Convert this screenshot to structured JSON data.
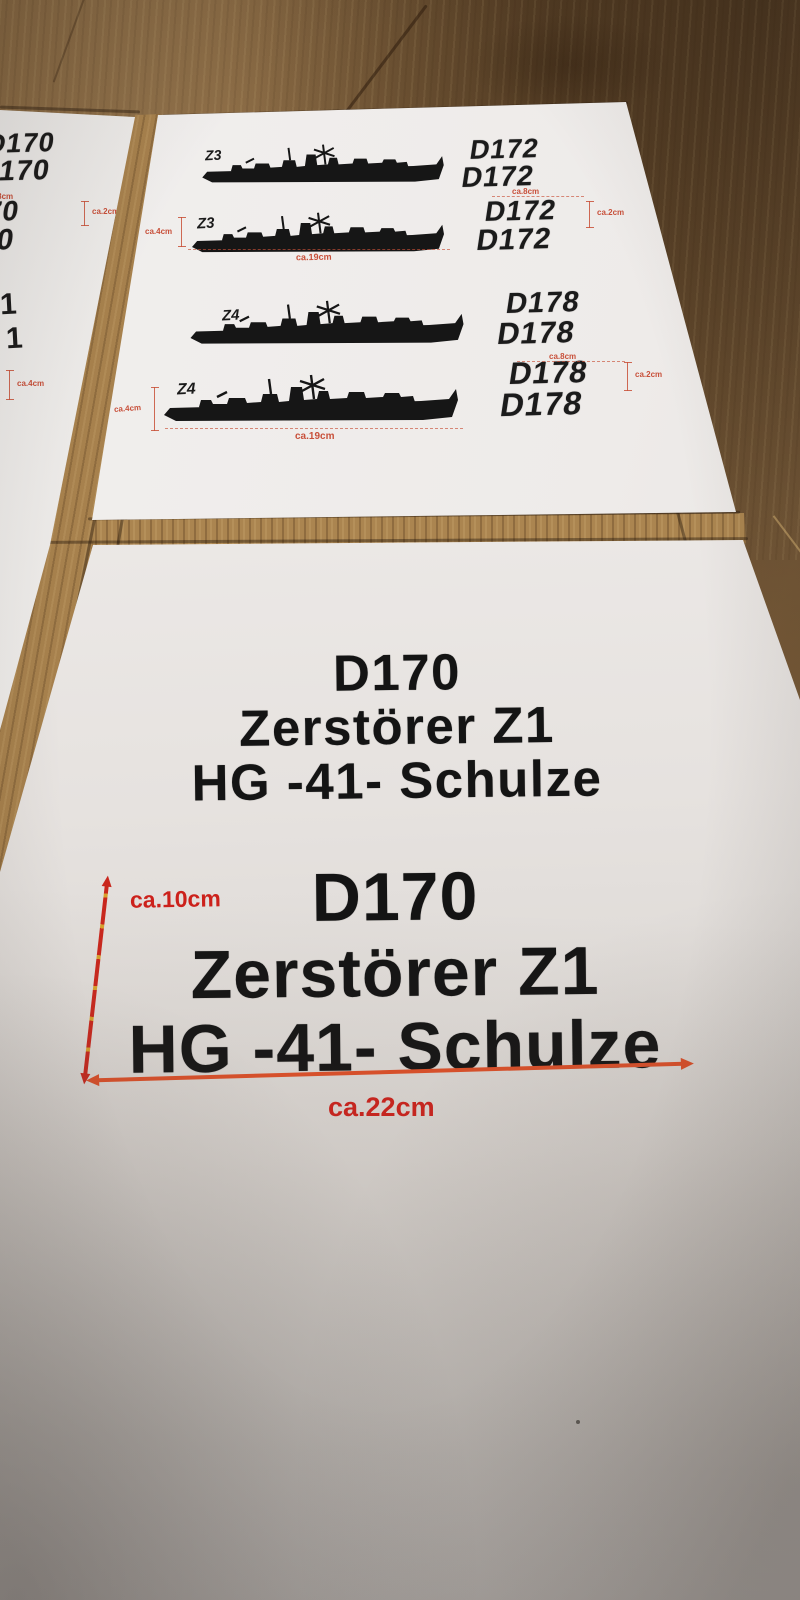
{
  "colors": {
    "wood": "#8a6840",
    "paper": "#f0eeec",
    "ink": "#1b1b1b",
    "annotation_red": "#c8503a",
    "arrow_orange": "#dd4f28",
    "arrow_red": "#c9271d"
  },
  "sheet_top": {
    "rows": [
      {
        "ship_label": "Z3",
        "reg": [
          "D172",
          "D172"
        ]
      },
      {
        "ship_label": "Z3",
        "reg": [
          "D172",
          "D172"
        ],
        "dim_length": "ca.19cm",
        "dim_height": "ca.4cm",
        "dim_reg_width": "ca.8cm",
        "dim_reg_height": "ca.2cm"
      },
      {
        "ship_label": "Z4",
        "reg": [
          "D178",
          "D178"
        ]
      },
      {
        "ship_label": "Z4",
        "reg": [
          "D178",
          "D178"
        ],
        "dim_length": "ca.19cm",
        "dim_height": "ca.4cm",
        "dim_reg_width": "ca.8cm",
        "dim_reg_height": "ca.2cm"
      }
    ]
  },
  "sheet_left": {
    "pairs": [
      [
        "D170",
        "D170"
      ],
      [
        "D170",
        "D170"
      ]
    ],
    "fragments": [
      "1",
      "1"
    ],
    "dim_reg_width": "ca.8cm",
    "dim_reg_height": "ca.2cm",
    "dim_height": "ca.4cm"
  },
  "sheet_bottom": {
    "small_block": [
      "D170",
      "Zerstörer Z1",
      "HG -41- Schulze"
    ],
    "large_block": [
      "D170",
      "Zerstörer Z1",
      "HG -41- Schulze"
    ],
    "dim_vertical": "ca.10cm",
    "dim_horizontal": "ca.22cm"
  }
}
